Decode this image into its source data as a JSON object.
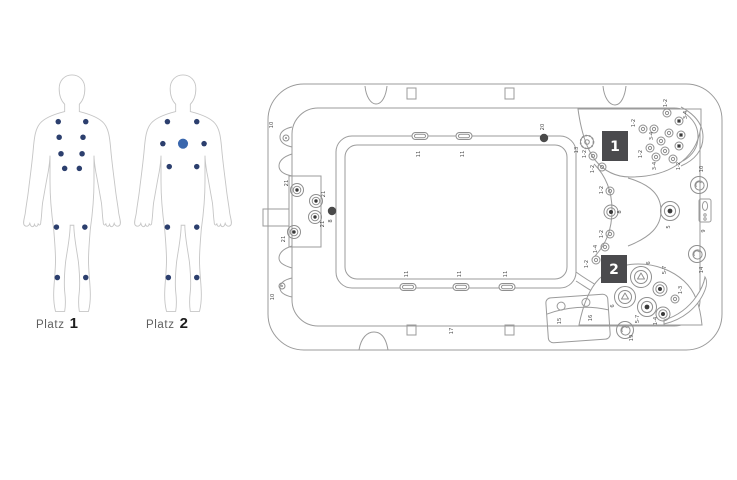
{
  "figures": {
    "platz1": {
      "prefix": "Platz",
      "number": "1",
      "dots": [
        [
          45,
          55
        ],
        [
          75,
          55
        ],
        [
          46,
          72
        ],
        [
          72,
          72
        ],
        [
          48,
          90
        ],
        [
          71,
          90
        ],
        [
          52,
          106
        ],
        [
          68,
          106
        ],
        [
          43,
          170
        ],
        [
          74,
          170
        ],
        [
          44,
          225
        ],
        [
          75,
          225
        ]
      ]
    },
    "platz2": {
      "prefix": "Platz",
      "number": "2",
      "dots": [
        [
          43,
          55
        ],
        [
          75,
          55
        ],
        [
          38,
          79
        ],
        [
          83,
          79
        ],
        [
          45,
          104
        ],
        [
          75,
          104
        ],
        [
          43,
          170
        ],
        [
          75,
          170
        ],
        [
          44,
          225
        ],
        [
          75,
          225
        ]
      ],
      "large_dot": [
        60,
        79
      ]
    }
  },
  "tub": {
    "seat_badges": [
      {
        "label": "1",
        "x": 340,
        "y": 57,
        "w": 26,
        "h": 30
      },
      {
        "label": "2",
        "x": 339,
        "y": 181,
        "w": 26,
        "h": 28
      }
    ],
    "jets": [
      {
        "type": "mini",
        "x": 24,
        "y": 64
      },
      {
        "type": "mini",
        "x": 20,
        "y": 212
      },
      {
        "type": "panel",
        "x": 35,
        "y": 116
      },
      {
        "type": "panel",
        "x": 54,
        "y": 127
      },
      {
        "type": "panel",
        "x": 53,
        "y": 143
      },
      {
        "type": "panel",
        "x": 32,
        "y": 158
      },
      {
        "type": "darkdot",
        "x": 70,
        "y": 137
      },
      {
        "type": "darkdot",
        "x": 282,
        "y": 64
      },
      {
        "type": "gear",
        "x": 325,
        "y": 68
      },
      {
        "type": "small",
        "x": 331,
        "y": 82
      },
      {
        "type": "small",
        "x": 340,
        "y": 93
      },
      {
        "type": "small",
        "x": 348,
        "y": 117
      },
      {
        "type": "med",
        "x": 349,
        "y": 138
      },
      {
        "type": "small",
        "x": 348,
        "y": 160
      },
      {
        "type": "small",
        "x": 343,
        "y": 173
      },
      {
        "type": "small",
        "x": 334,
        "y": 186
      },
      {
        "type": "small",
        "x": 405,
        "y": 39
      },
      {
        "type": "sdark",
        "x": 417,
        "y": 47
      },
      {
        "type": "small",
        "x": 381,
        "y": 55
      },
      {
        "type": "small",
        "x": 392,
        "y": 55
      },
      {
        "type": "small",
        "x": 407,
        "y": 59
      },
      {
        "type": "sdark",
        "x": 419,
        "y": 61
      },
      {
        "type": "small",
        "x": 399,
        "y": 67
      },
      {
        "type": "sdark",
        "x": 417,
        "y": 72
      },
      {
        "type": "small",
        "x": 388,
        "y": 74
      },
      {
        "type": "small",
        "x": 403,
        "y": 77
      },
      {
        "type": "small",
        "x": 394,
        "y": 83
      },
      {
        "type": "small",
        "x": 411,
        "y": 85
      },
      {
        "type": "big",
        "x": 408,
        "y": 137
      },
      {
        "type": "swirl",
        "x": 437,
        "y": 111
      },
      {
        "type": "swirl",
        "x": 435,
        "y": 180
      },
      {
        "type": "swirl",
        "x": 363,
        "y": 256
      },
      {
        "type": "prop",
        "x": 379,
        "y": 203
      },
      {
        "type": "prop",
        "x": 363,
        "y": 223
      },
      {
        "type": "med",
        "x": 398,
        "y": 215
      },
      {
        "type": "big",
        "x": 385,
        "y": 233
      },
      {
        "type": "med",
        "x": 401,
        "y": 240
      },
      {
        "type": "small",
        "x": 413,
        "y": 225
      }
    ],
    "fittings": [
      {
        "x": 158,
        "y": 62
      },
      {
        "x": 202,
        "y": 62
      },
      {
        "x": 146,
        "y": 213
      },
      {
        "x": 199,
        "y": 213
      },
      {
        "x": 245,
        "y": 213
      }
    ],
    "labels": [
      {
        "t": "10",
        "x": 11,
        "y": 51
      },
      {
        "t": "10",
        "x": 12,
        "y": 223
      },
      {
        "t": "8",
        "x": 70,
        "y": 147
      },
      {
        "t": "21",
        "x": 26,
        "y": 109
      },
      {
        "t": "21",
        "x": 63,
        "y": 120
      },
      {
        "t": "21",
        "x": 62,
        "y": 150
      },
      {
        "t": "21",
        "x": 23,
        "y": 165
      },
      {
        "t": "20",
        "x": 282,
        "y": 53
      },
      {
        "t": "13",
        "x": 316,
        "y": 76
      },
      {
        "t": "11",
        "x": 158,
        "y": 80
      },
      {
        "t": "11",
        "x": 202,
        "y": 80
      },
      {
        "t": "11",
        "x": 146,
        "y": 200
      },
      {
        "t": "11",
        "x": 199,
        "y": 200
      },
      {
        "t": "11",
        "x": 245,
        "y": 200
      },
      {
        "t": "17",
        "x": 191,
        "y": 257
      },
      {
        "t": "10",
        "x": 441,
        "y": 95
      },
      {
        "t": "9",
        "x": 443,
        "y": 157
      },
      {
        "t": "14",
        "x": 441,
        "y": 196
      },
      {
        "t": "1-2",
        "x": 405,
        "y": 29
      },
      {
        "t": "3-4",
        "x": 425,
        "y": 41
      },
      {
        "t": "1-2",
        "x": 373,
        "y": 49
      },
      {
        "t": "3-4",
        "x": 391,
        "y": 62
      },
      {
        "t": "1-2",
        "x": 380,
        "y": 80
      },
      {
        "t": "3-4",
        "x": 394,
        "y": 92
      },
      {
        "t": "1-2",
        "x": 418,
        "y": 92
      },
      {
        "t": "1-2",
        "x": 324,
        "y": 80
      },
      {
        "t": "1-2",
        "x": 332,
        "y": 95
      },
      {
        "t": "1-2",
        "x": 341,
        "y": 116
      },
      {
        "t": "8",
        "x": 359,
        "y": 138
      },
      {
        "t": "1-2",
        "x": 341,
        "y": 160
      },
      {
        "t": "1-4",
        "x": 335,
        "y": 175
      },
      {
        "t": "1-2",
        "x": 326,
        "y": 190
      },
      {
        "t": "5",
        "x": 408,
        "y": 153
      },
      {
        "t": "6",
        "x": 388,
        "y": 189
      },
      {
        "t": "5-7",
        "x": 404,
        "y": 196
      },
      {
        "t": "1-3",
        "x": 420,
        "y": 216
      },
      {
        "t": "6",
        "x": 352,
        "y": 232
      },
      {
        "t": "5-7",
        "x": 377,
        "y": 245
      },
      {
        "t": "1-4",
        "x": 395,
        "y": 247
      },
      {
        "t": "19",
        "x": 371,
        "y": 264
      },
      {
        "t": "15",
        "x": 299,
        "y": 247
      },
      {
        "t": "16",
        "x": 330,
        "y": 244
      }
    ]
  },
  "colors": {
    "outline": "#9b9b9b",
    "jet": "#8f8f8f",
    "jet_dark": "#3a3a3a",
    "label": "#4d4d4d",
    "badge_bg": "#4a4a4d",
    "badge_text": "#ffffff",
    "dot": "#2c3f6e",
    "dot_large": "#3a67ad",
    "figure_outline": "#c6c6c6",
    "caption": "#5f5f5f",
    "caption_number": "#1d1d1d"
  }
}
